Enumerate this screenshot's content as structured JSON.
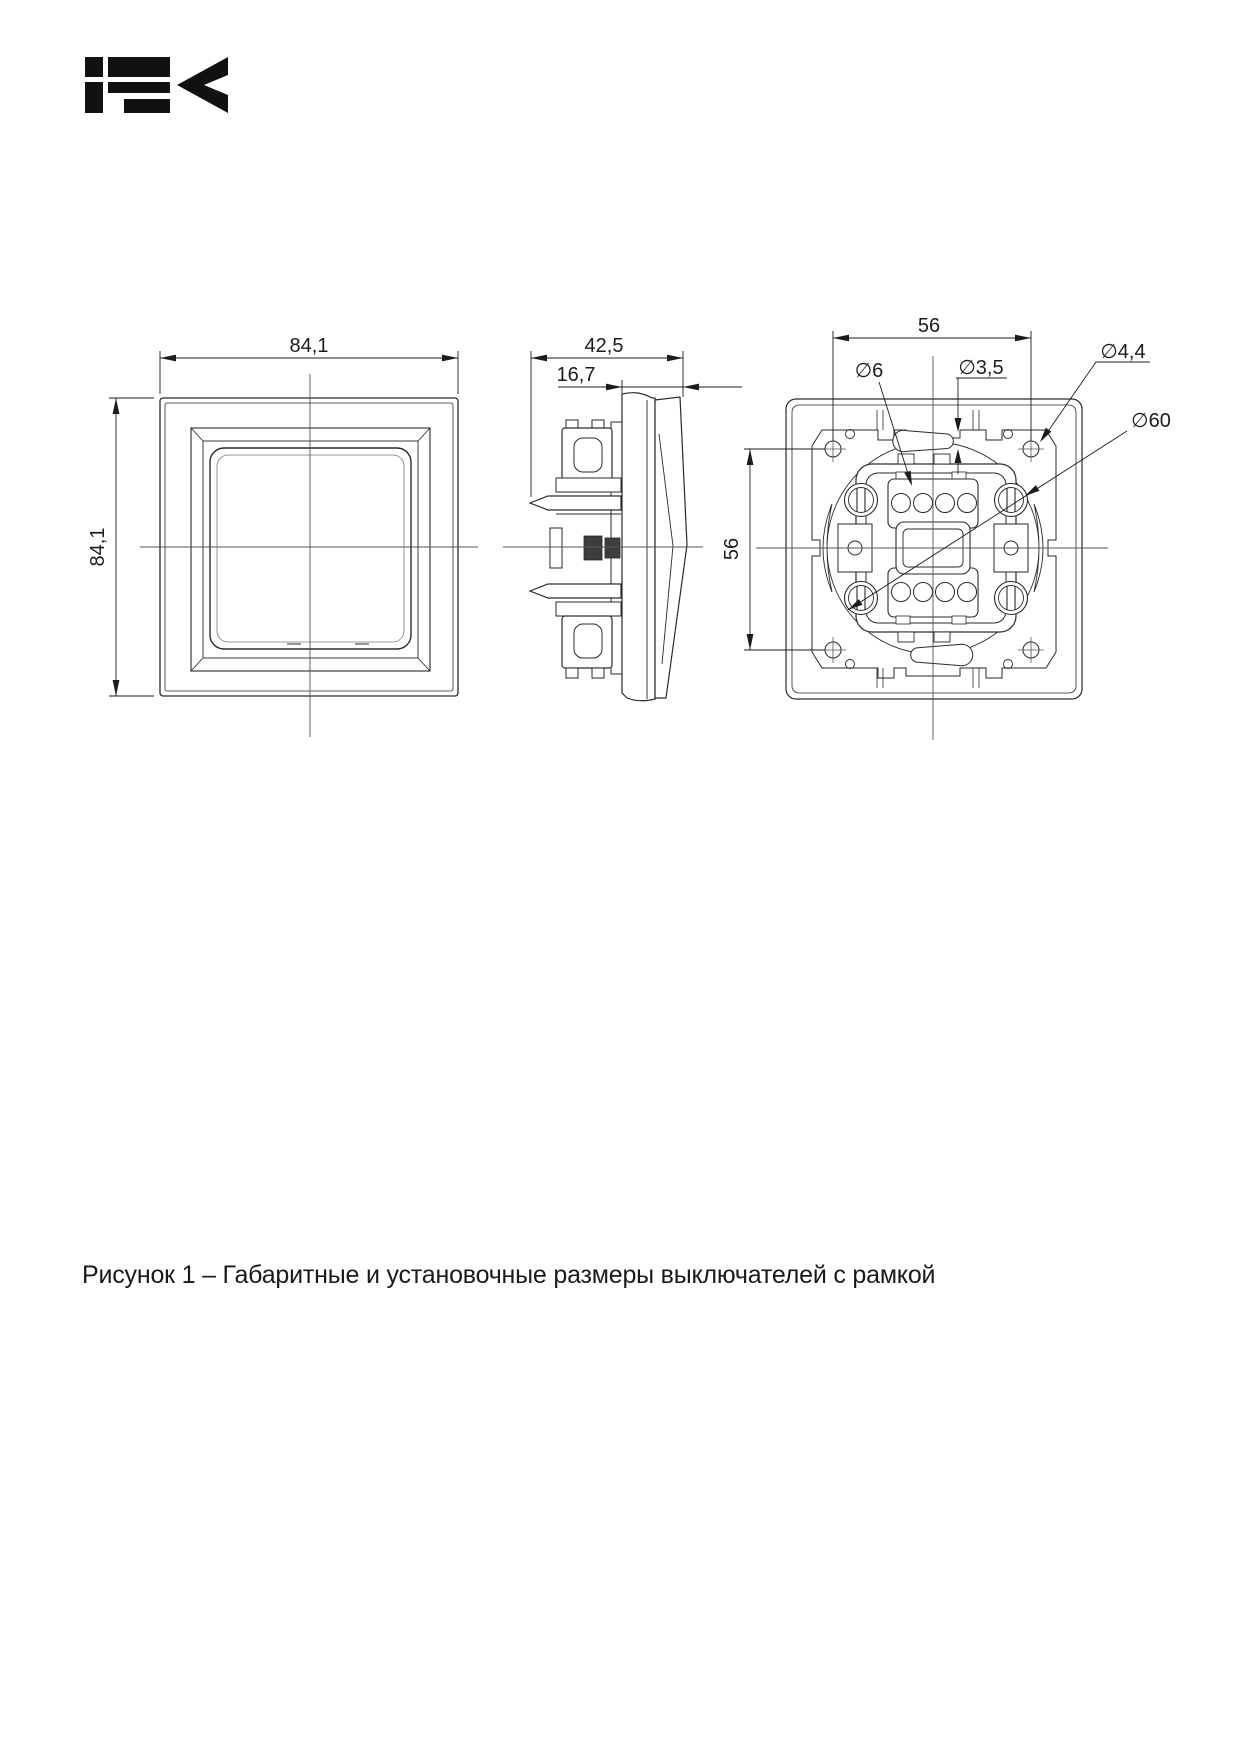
{
  "page": {
    "background": "#ffffff",
    "ink_color": "#2a2a2a",
    "centerline_color": "#555555"
  },
  "logo": {
    "brand": "IEK",
    "color": "#111111"
  },
  "figure_caption": "Рисунок 1 – Габаритные и установочные размеры выключателей с рамкой",
  "dimensions": {
    "front_view": {
      "width": "84,1",
      "height": "84,1"
    },
    "side_view": {
      "total_depth": "42,5",
      "flush_depth": "16,7"
    },
    "back_view": {
      "mounting_span_horizontal": "56",
      "mounting_span_vertical": "56",
      "slot_diameter_wide": "∅6",
      "slot_diameter_narrow": "∅3,5",
      "hole_diameter": "∅4,4",
      "support_circle_diameter": "∅60"
    }
  }
}
